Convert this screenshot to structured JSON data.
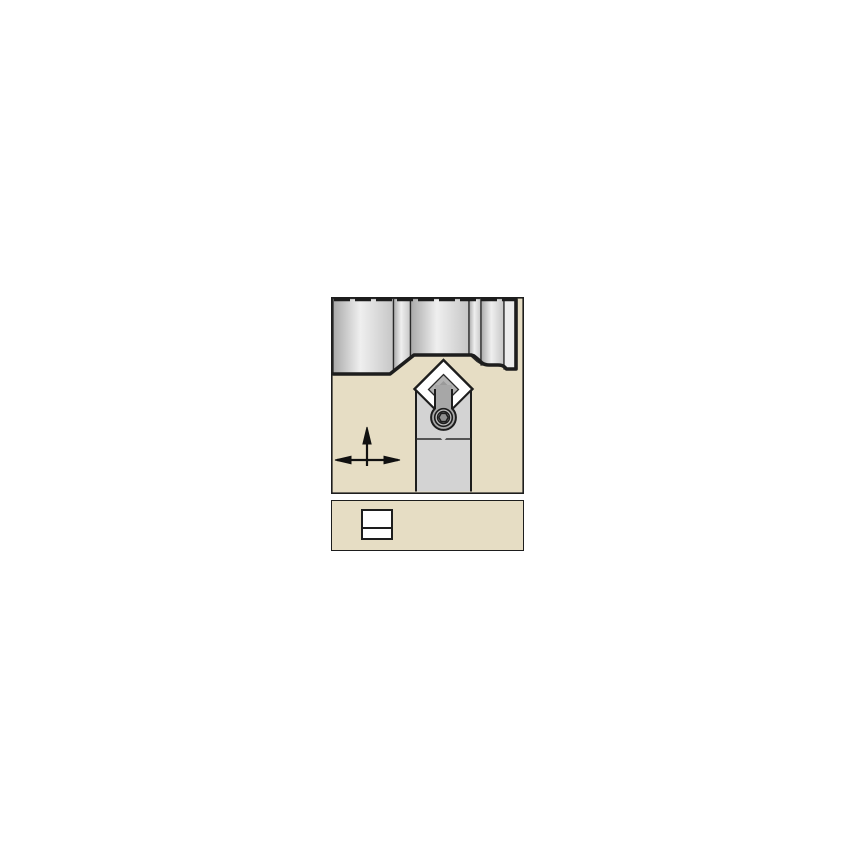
{
  "page": {
    "kind": "catalog-line-art",
    "subject": "lathe-toolholder-with-clamped-insert-cutting-workpiece"
  },
  "colors": {
    "canvas": "#ffffff",
    "panel_bg": "#e6ddc4",
    "outline": "#1d1d1d",
    "divider": "#2a2a2a",
    "wp_dark": "#a9a9a9",
    "wp_light": "#efefef",
    "wp_mid": "#c6c6c6",
    "wp_end": "#ececec",
    "holder": "#d3d3d3",
    "clamp": "#a7a7a7",
    "insert": "#ffffff",
    "shim": "#b3b3b3",
    "shim_dark": "#9a9a9a",
    "screw": "#8f8f8f",
    "screw_ring": "#bdbdbd",
    "symbol": "#111111"
  },
  "icons": {
    "feed_direction": "up-and-lateral-arrows",
    "insert_section": "rectangular-insert-cross-section",
    "clamp_screw": "hex-socket-screw"
  }
}
